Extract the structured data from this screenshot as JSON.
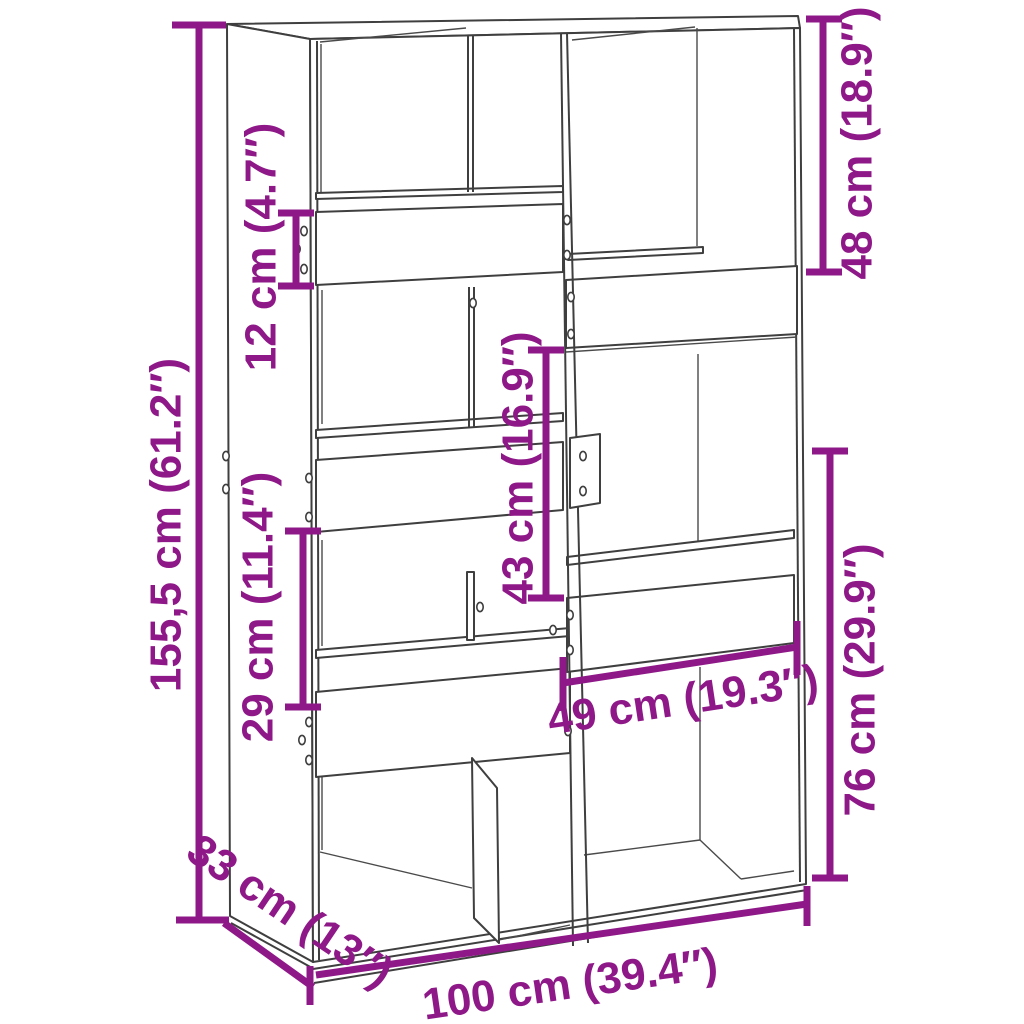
{
  "diagram": {
    "type": "furniture-dimension-diagram",
    "subject": "bookcase-room-divider-line-drawing",
    "colors": {
      "dimension": "#8e1888",
      "outline": "#3f3f3f",
      "background": "#ffffff"
    },
    "dimensions": [
      {
        "id": "overall-height",
        "label": "155,5 cm (61.2″)",
        "cm": "155,5",
        "inch": "61.2",
        "orientation": "vertical",
        "location": "left-edge"
      },
      {
        "id": "shelf-rail-height",
        "label": "12 cm (4.7″)",
        "cm": "12",
        "inch": "4.7",
        "orientation": "vertical",
        "location": "upper-left-shelf"
      },
      {
        "id": "upper-right-opening",
        "label": "48 cm (18.9″)",
        "cm": "48",
        "inch": "18.9",
        "orientation": "vertical",
        "location": "upper-right"
      },
      {
        "id": "middle-opening",
        "label": "43 cm (16.9″)",
        "cm": "43",
        "inch": "16.9",
        "orientation": "vertical",
        "location": "center"
      },
      {
        "id": "mid-left-opening",
        "label": "29 cm (11.4″)",
        "cm": "29",
        "inch": "11.4",
        "orientation": "vertical",
        "location": "mid-left"
      },
      {
        "id": "lower-right-opening",
        "label": "76 cm (29.9″)",
        "cm": "76",
        "inch": "29.9",
        "orientation": "vertical",
        "location": "lower-right"
      },
      {
        "id": "right-opening-width",
        "label": "49 cm (19.3″)",
        "cm": "49",
        "inch": "19.3",
        "orientation": "horizontal",
        "location": "center-right"
      },
      {
        "id": "depth",
        "label": "33 cm (13″)",
        "cm": "33",
        "inch": "13",
        "orientation": "diagonal",
        "location": "bottom-left"
      },
      {
        "id": "overall-width",
        "label": "100 cm (39.4″)",
        "cm": "100",
        "inch": "39.4",
        "orientation": "horizontal",
        "location": "bottom"
      }
    ]
  }
}
